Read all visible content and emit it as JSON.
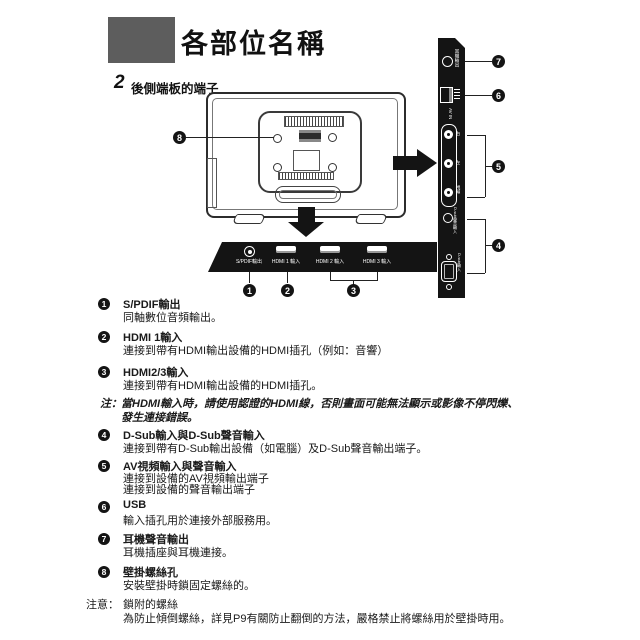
{
  "page": {
    "title": "各部位名稱"
  },
  "section": {
    "number": "2",
    "title": "後側端板的端子"
  },
  "diagram": {
    "callouts": [
      "1",
      "2",
      "3",
      "4",
      "5",
      "6",
      "7",
      "8"
    ],
    "bottom_panel": {
      "ports": [
        {
          "label": "S/PDIF輸出"
        },
        {
          "label": "HDMI 1 輸入"
        },
        {
          "label": "HDMI 2 輸入"
        },
        {
          "label": "HDMI 3 輸入"
        }
      ]
    },
    "side_panel": {
      "headphone_label": "耳機輸出",
      "av_in_label": "AV IN",
      "rca_labels": [
        "右",
        "左",
        "視頻"
      ],
      "dsub_audio_label": "D-sub聲音輸入",
      "dsub_label": "D-sub輸入"
    }
  },
  "list": {
    "items": [
      {
        "num": "1",
        "title": "S/PDIF輸出",
        "desc": "同軸數位音頻輸出。"
      },
      {
        "num": "2",
        "title": "HDMI 1輸入",
        "desc": "連接到帶有HDMI輸出設備的HDMI插孔（例如：音響）"
      },
      {
        "num": "3",
        "title": "HDMI2/3輸入",
        "desc": "連接到帶有HDMI輸出設備的HDMI插孔。"
      },
      {
        "num": "4",
        "title": "D-Sub輸入與D-Sub聲音輸入",
        "desc": "連接到帶有D-Sub輸出設備（如電腦）及D-Sub聲音輸出端子。"
      },
      {
        "num": "5",
        "title": "AV視頻輸入與聲音輸入",
        "desc": "連接到設備的AV視頻輸出端子",
        "desc2": "連接到設備的聲音輸出端子"
      },
      {
        "num": "6",
        "title": "USB",
        "desc": "輸入插孔用於連接外部服務用。"
      },
      {
        "num": "7",
        "title": "耳機聲音輸出",
        "desc": "耳機插座與耳機連接。"
      },
      {
        "num": "8",
        "title": "壁掛螺絲孔",
        "desc": "安裝壁掛時鎖固定螺絲的。"
      }
    ]
  },
  "notes": {
    "hdmi": {
      "prefix": "注：",
      "line1": "當HDMI輸入時，請使用認證的HDMI線，否則畫面可能無法顯示或影像不停閃爍、",
      "line2": "發生連接錯誤。"
    },
    "caution": {
      "prefix": "注意：",
      "line1": "鎖附的螺絲",
      "line2": "為防止傾倒螺絲，詳見P9有關防止翻倒的方法，嚴格禁止將螺絲用於壁掛時用。"
    }
  }
}
